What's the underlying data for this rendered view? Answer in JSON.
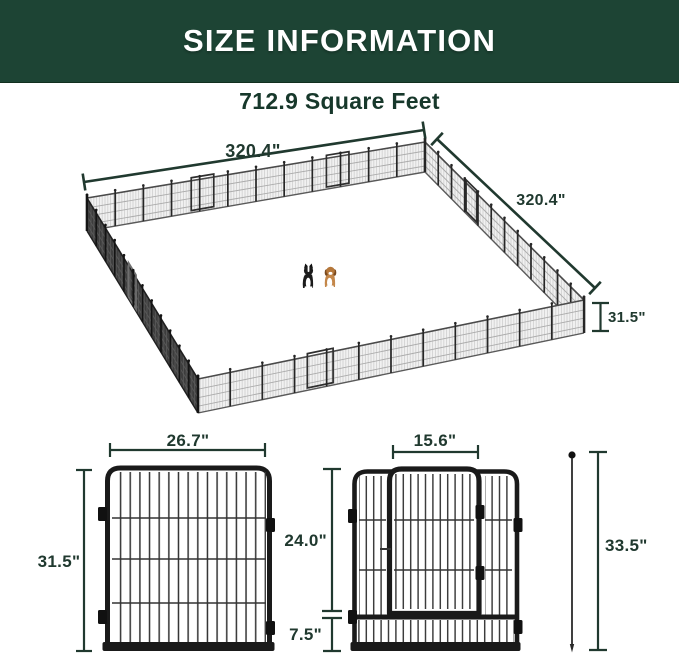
{
  "header": {
    "title": "SIZE INFORMATION"
  },
  "subtitle": {
    "text": "712.9 Square Feet"
  },
  "pen_diagram": {
    "dim_top_width": "320.4\"",
    "dim_right_width": "320.4\"",
    "dim_fence_height": "31.5\"",
    "panels_per_side": 12,
    "animals": [
      "border-collie",
      "beagle"
    ]
  },
  "single_panel_diagram": {
    "dim_width": "26.7\"",
    "dim_height": "31.5\""
  },
  "door_panel_diagram": {
    "dim_door_width": "15.6\"",
    "dim_door_height": "24.0\"",
    "dim_bottom_height": "7.5\""
  },
  "ground_stake_diagram": {
    "dim_height": "33.5\""
  },
  "colors": {
    "header_bg": "#1d4434",
    "header_text": "#ffffff",
    "dimension_text": "#20392f",
    "fence_black": "#1a1a1a"
  }
}
